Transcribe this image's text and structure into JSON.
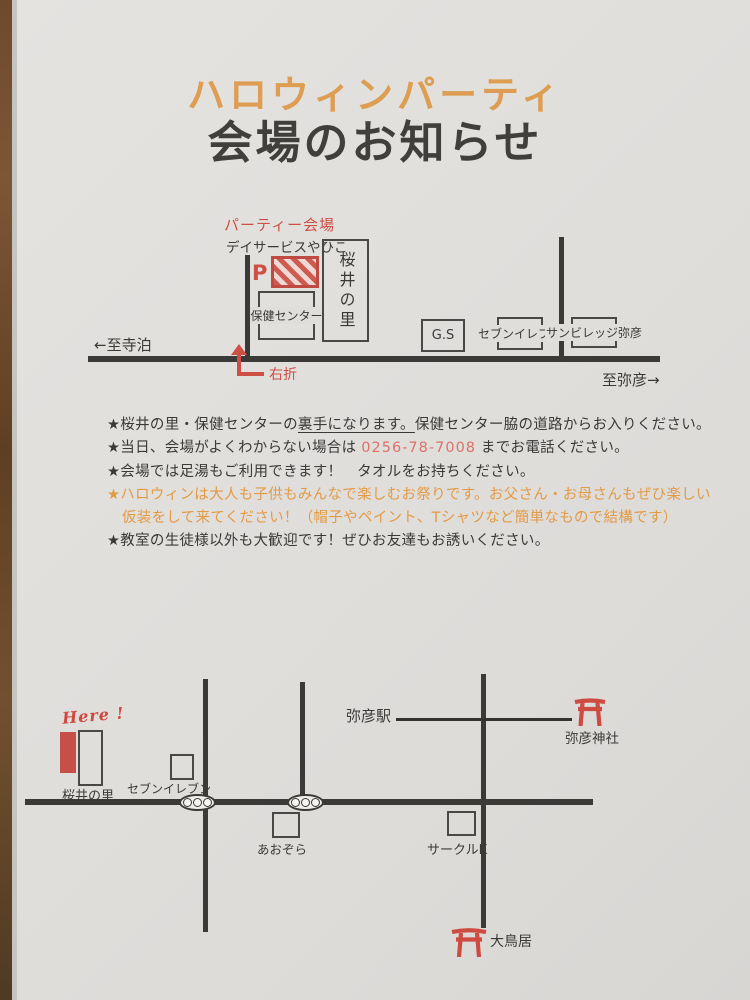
{
  "page": {
    "title": "ハロウィンパーティ",
    "subtitle": "会場のお知らせ"
  },
  "map1": {
    "venue_label": "パーティー会場",
    "dayservice_label": "デイサービスやひこ",
    "parking_label": "P",
    "health_center_label": "保健センター",
    "sakurai_label": "桜井の里",
    "gs_label": "G.S",
    "seven_label": "セブンイレブン",
    "sunvillage_label": "サンビレッジ弥彦",
    "to_teradomari": "←至寺泊",
    "to_yahiko": "至弥彦→",
    "turn_right_label": "右折"
  },
  "notes": {
    "line1_pre": "★桜井の里・保健センターの",
    "line1_underline": "裏手になります。",
    "line1_post": "保健センター脇の道路からお入りください。",
    "line2_pre": "★当日、会場がよくわからない場合は ",
    "line2_phone": "0256-78-7008",
    "line2_post": " までお電話ください。",
    "line3": "★会場では足湯もご利用できます！　タオルをお持ちください。",
    "line4": "★ハロウィンは大人も子供もみんなで楽しむお祭りです。お父さん・お母さんもぜひ楽しい",
    "line5": "仮装をして来てください！（帽子やペイント、Tシャツなど簡単なもので結構です）",
    "line6": "★教室の生徒様以外も大歓迎です！ぜひお友達もお誘いください。"
  },
  "map2": {
    "here_label": "Here !",
    "sakurai_label": "桜井の里",
    "seven_label": "セブンイレブン",
    "aozora_label": "あおぞら",
    "station_label": "弥彦駅",
    "shrine_label": "弥彦神社",
    "circlek_label": "サークルK",
    "otorii_label": "大鳥居"
  },
  "colors": {
    "accent_red": "#ce4f45",
    "accent_orange": "#dd9d52",
    "note_orange": "#e39a45",
    "phone_pink": "#dd7168",
    "paper": "#e0dedb",
    "road_dark": "#3b3a38"
  }
}
